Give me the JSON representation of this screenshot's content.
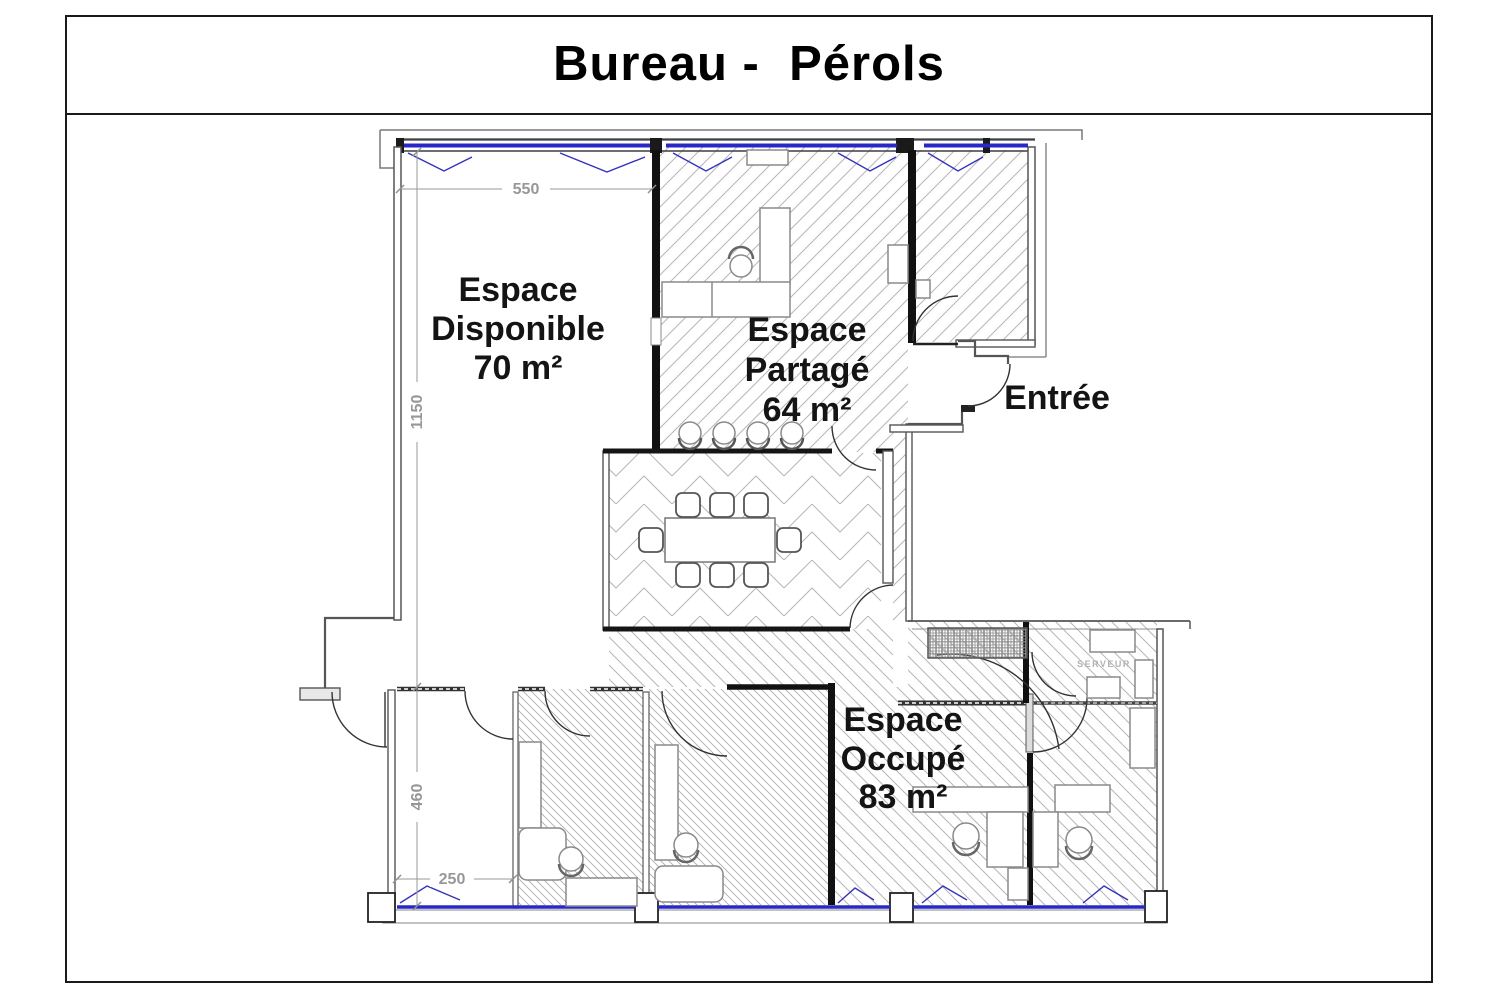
{
  "title": "Bureau -  Pérols",
  "rooms": {
    "disponible": {
      "lines": [
        "Espace",
        "Disponible",
        "70 m²"
      ]
    },
    "partage": {
      "lines": [
        "Espace",
        "Partagé",
        "64 m²"
      ]
    },
    "occupe": {
      "lines": [
        "Espace",
        "Occupé",
        "83 m²"
      ]
    },
    "entree": {
      "label": "Entrée"
    },
    "serveur": {
      "label": "SERVEUR"
    }
  },
  "dims": [
    {
      "id": "top-width",
      "label": "550"
    },
    {
      "id": "left-height",
      "label": "1150"
    },
    {
      "id": "lower-left-height",
      "label": "460"
    },
    {
      "id": "lower-left-width",
      "label": "250"
    }
  ],
  "colors": {
    "window_blue": "#2828c8",
    "wall_dark": "#111111",
    "wall_gray": "#555555",
    "hatch_gray": "#b6b6b6",
    "dimension_gray": "#979797"
  }
}
